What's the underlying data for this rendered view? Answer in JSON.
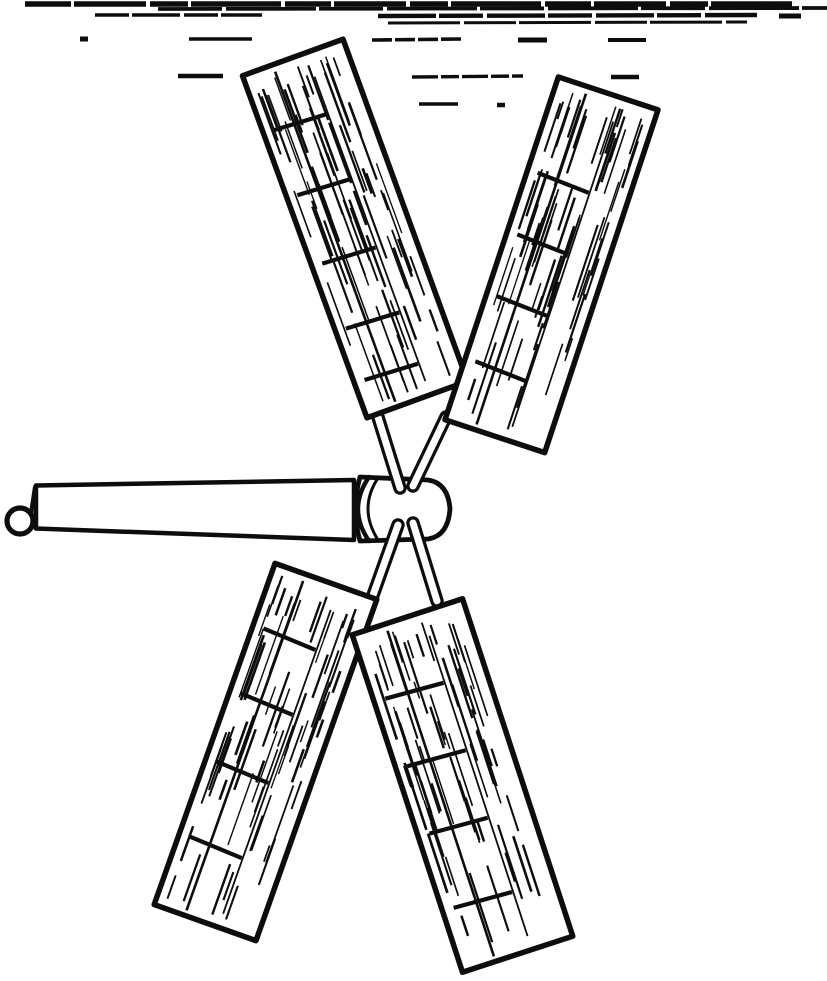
{
  "figure": {
    "kind": "vintage-line-engraving",
    "subject": "four-bladed-windmill-rotor-on-horizontal-shaft",
    "colors": {
      "ink": "#0d0d0d",
      "paper": "#ffffff"
    },
    "canvas": {
      "width": 827,
      "height": 981
    },
    "sky": {
      "segments": [
        {
          "x1": 25,
          "y1": 4,
          "x2": 792,
          "y2": 4,
          "w": 5.5,
          "dash": "46 3 72 4 38 3 90 4"
        },
        {
          "x1": 158,
          "y1": 9,
          "x2": 827,
          "y2": 8,
          "w": 3.8,
          "dash": "64 4 90 3"
        },
        {
          "x1": 95,
          "y1": 15,
          "x2": 262,
          "y2": 15,
          "w": 3.4,
          "dash": "34 3 48 4"
        },
        {
          "x1": 378,
          "y1": 16,
          "x2": 757,
          "y2": 15,
          "w": 4.4,
          "dash": "58 3 44 4"
        },
        {
          "x1": 779,
          "y1": 16,
          "x2": 801,
          "y2": 16,
          "w": 5,
          "dash": ""
        },
        {
          "x1": 388,
          "y1": 23,
          "x2": 747,
          "y2": 22,
          "w": 3,
          "dash": "72 4 52 3"
        },
        {
          "x1": 80,
          "y1": 39,
          "x2": 88,
          "y2": 39,
          "w": 5,
          "dash": ""
        },
        {
          "x1": 189,
          "y1": 39,
          "x2": 252,
          "y2": 39,
          "w": 3.6,
          "dash": ""
        },
        {
          "x1": 372,
          "y1": 40,
          "x2": 462,
          "y2": 39,
          "w": 3.6,
          "dash": "20 3"
        },
        {
          "x1": 518,
          "y1": 40,
          "x2": 547,
          "y2": 40,
          "w": 5,
          "dash": ""
        },
        {
          "x1": 608,
          "y1": 40,
          "x2": 646,
          "y2": 40,
          "w": 4,
          "dash": ""
        },
        {
          "x1": 178,
          "y1": 76,
          "x2": 223,
          "y2": 76,
          "w": 4.6,
          "dash": ""
        },
        {
          "x1": 412,
          "y1": 77,
          "x2": 523,
          "y2": 76,
          "w": 3.4,
          "dash": "26 3 18 3"
        },
        {
          "x1": 611,
          "y1": 77,
          "x2": 639,
          "y2": 77,
          "w": 4.6,
          "dash": ""
        },
        {
          "x1": 419,
          "y1": 104,
          "x2": 458,
          "y2": 104,
          "w": 3.4,
          "dash": ""
        },
        {
          "x1": 497,
          "y1": 105,
          "x2": 505,
          "y2": 105,
          "w": 4.5,
          "dash": ""
        }
      ]
    },
    "shaft": {
      "points": "36,485.5 354,480 354,540 36,528.5",
      "cap": {
        "x1": 35,
        "y1": 487,
        "x2": 31,
        "y2": 514,
        "w": 4.2
      },
      "ring": {
        "cx": 20,
        "cy": 521,
        "r": 13,
        "w": 5.2
      }
    },
    "hub": {
      "body": "M 360,477 L 428,480 Q 448,483 450,509 Q 448,536 428,539 L 360,541 Q 351,509 360,477 Z",
      "collar": [
        {
          "d": "M 369,477 Q 358,493 358,509 Q 358,525 369,541",
          "w": 4.4
        },
        {
          "d": "M 378,478 Q 368,493 368,509 Q 368,524 378,540",
          "w": 3
        }
      ]
    },
    "arms": {
      "outer_w": 13.5,
      "inner_w": 7,
      "items": [
        {
          "name": "upper-left",
          "x1": 377,
          "y1": 414,
          "x2": 400,
          "y2": 488
        },
        {
          "name": "upper-right",
          "x1": 446,
          "y1": 417,
          "x2": 413,
          "y2": 486
        },
        {
          "name": "lower-left",
          "x1": 372,
          "y1": 598,
          "x2": 398,
          "y2": 525
        },
        {
          "name": "lower-right",
          "x1": 437,
          "y1": 601,
          "x2": 413,
          "y2": 523
        }
      ]
    },
    "blades": {
      "border_w": 5.5,
      "batten_w": 4.2,
      "batten_x1": -0.4,
      "batten_x2": 0.12,
      "stiles": [
        {
          "x": -0.2,
          "t1": 0.02,
          "t2": 0.985,
          "w": 2.6
        },
        {
          "x": 0.13,
          "t1": 0.07,
          "t2": 0.96,
          "w": 1.8
        }
      ],
      "items": [
        {
          "name": "upper-left",
          "cx": 355,
          "cy": 228.5,
          "angle": -20,
          "w": 107,
          "h": 364,
          "seed": 7,
          "battens": [
            0.17,
            0.36,
            0.56,
            0.75,
            0.9
          ],
          "grain": 34
        },
        {
          "name": "upper-right",
          "cx": 551.5,
          "cy": 264.8,
          "angle": 18.3,
          "w": 105,
          "h": 361,
          "seed": 11,
          "battens": [
            0.27,
            0.45,
            0.63,
            0.82
          ],
          "grain": 34
        },
        {
          "name": "lower-left",
          "cx": 265.5,
          "cy": 752,
          "angle": 19.5,
          "w": 108,
          "h": 362,
          "seed": 19,
          "battens": [
            0.18,
            0.37,
            0.57,
            0.79
          ],
          "grain": 34
        },
        {
          "name": "lower-right",
          "cx": 462.5,
          "cy": 785.5,
          "angle": -18.1,
          "w": 116,
          "h": 355,
          "seed": 23,
          "battens": [
            0.2,
            0.4,
            0.6,
            0.82
          ],
          "grain": 36
        }
      ]
    }
  }
}
